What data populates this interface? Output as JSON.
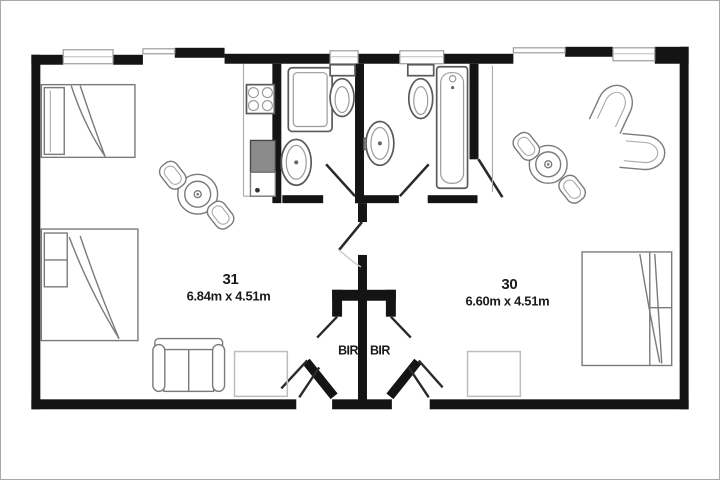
{
  "plan": {
    "rooms": [
      {
        "number": "31",
        "dimensions": "6.84m x 4.51m"
      },
      {
        "number": "30",
        "dimensions": "6.60m x 4.51m"
      }
    ],
    "closet_labels": {
      "left": "BIR",
      "right": "BIR"
    }
  },
  "colors": {
    "wall": "#141414",
    "furniture_line": "#7a7a7a",
    "light_line": "#bdbdbd",
    "background": "#ffffff",
    "frame": "#a8a8a8",
    "text": "#1a1a1a"
  },
  "fixtures": [
    "single-bed",
    "double-bed",
    "dining-table",
    "chair",
    "sofa",
    "tub-chair",
    "rug",
    "cooktop",
    "refrigerator",
    "kitchen-cabinet",
    "shower",
    "toilet",
    "wash-basin",
    "bathtub",
    "window",
    "entry-door",
    "bathroom-door",
    "interconnecting-door",
    "built-in-robe"
  ]
}
